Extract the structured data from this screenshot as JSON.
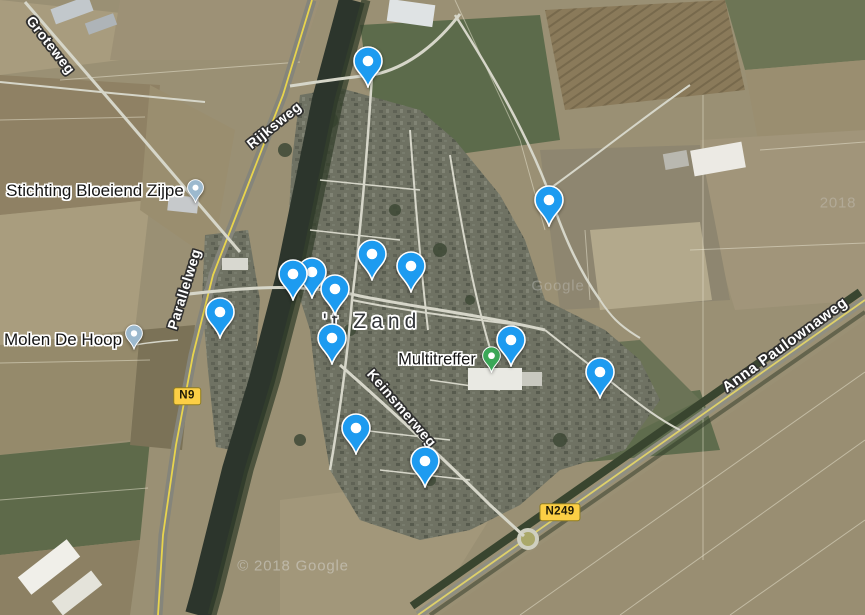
{
  "map": {
    "town_label": "'t Zand",
    "watermark_bottom": "© 2018 Google",
    "watermark_mid": "Google",
    "watermark_topright": "2018"
  },
  "labels": {
    "groteweg": "Groteweg",
    "rijksweg": "Rijksweg",
    "parallelweg": "Parallelweg",
    "keinsmerweg": "Keinsmerweg",
    "anna_paulownaweg": "Anna Paulownaweg",
    "stichting": "Stichting Bloeiend Zijpe",
    "molen": "Molen De Hoop",
    "multitreffer": "Multitreffer"
  },
  "badges": {
    "n9": "N9",
    "n249": "N249"
  },
  "colors": {
    "pin_blue": "#1d9bf0",
    "poi_gray": "#9cb9ce",
    "poi_green": "#3aa757",
    "badge_yellow": "#fccf45"
  },
  "pins": {
    "saved": [
      {
        "x": 549,
        "y": 200
      },
      {
        "x": 368,
        "y": 61
      },
      {
        "x": 372,
        "y": 254
      },
      {
        "x": 411,
        "y": 266
      },
      {
        "x": 312,
        "y": 272
      },
      {
        "x": 293,
        "y": 274
      },
      {
        "x": 335,
        "y": 289
      },
      {
        "x": 220,
        "y": 312
      },
      {
        "x": 332,
        "y": 338
      },
      {
        "x": 511,
        "y": 340
      },
      {
        "x": 600,
        "y": 372
      },
      {
        "x": 356,
        "y": 428
      },
      {
        "x": 425,
        "y": 461
      }
    ],
    "poi": [
      {
        "x": 195,
        "y": 188,
        "w": 17,
        "h": 24,
        "kind": "poi-gray"
      },
      {
        "x": 134,
        "y": 333,
        "w": 18,
        "h": 26,
        "kind": "poi-gray"
      },
      {
        "x": 491,
        "y": 356,
        "w": 19,
        "h": 27,
        "kind": "poi-green"
      }
    ]
  }
}
